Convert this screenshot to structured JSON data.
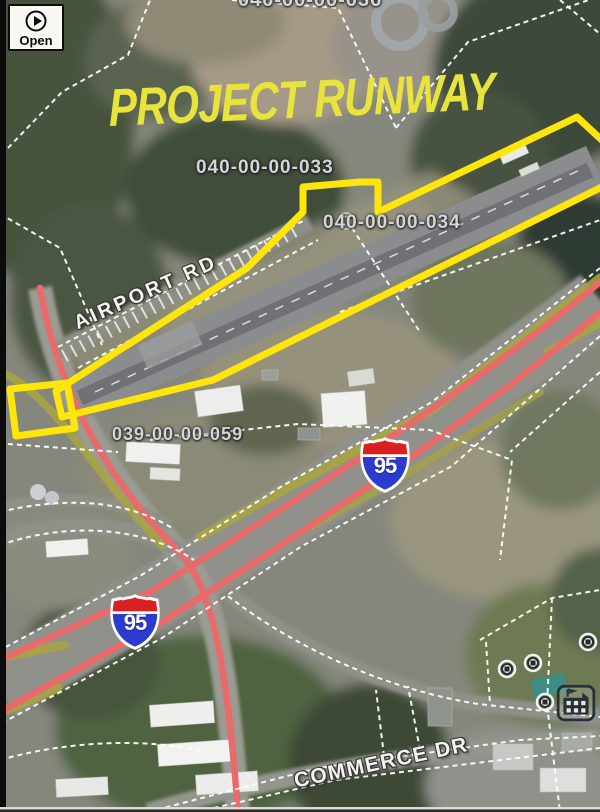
{
  "title": {
    "text": "PROJECT RUNWAY",
    "color": "#e9e43c"
  },
  "open_button": {
    "label": "Open",
    "icon": "play-circle-icon"
  },
  "parcels": [
    {
      "label": "040-00-00-036"
    },
    {
      "label": "040-00-00-033"
    },
    {
      "label": "040-00-00-034"
    },
    {
      "label": "039-00-00-059"
    }
  ],
  "roads": [
    {
      "label": "AIRPORT RD"
    },
    {
      "label": "COMMERCE DR"
    }
  ],
  "highway_shields": [
    {
      "system": "interstate",
      "number": "95"
    },
    {
      "system": "interstate",
      "number": "95"
    }
  ],
  "icons": [
    {
      "name": "play-circle-icon"
    },
    {
      "name": "building-icon"
    },
    {
      "name": "well-icon"
    },
    {
      "name": "interstate-shield-icon"
    }
  ],
  "colors": {
    "parcel_outline_yellow": "#ffe60a",
    "highway_red": "#e96a6b",
    "road_overlay_olive": "#a9a53e",
    "parcel_line_white": "#ffffff",
    "shield_blue": "#2b3bcf",
    "shield_red": "#d92020",
    "title_yellow": "#e9e43c"
  }
}
